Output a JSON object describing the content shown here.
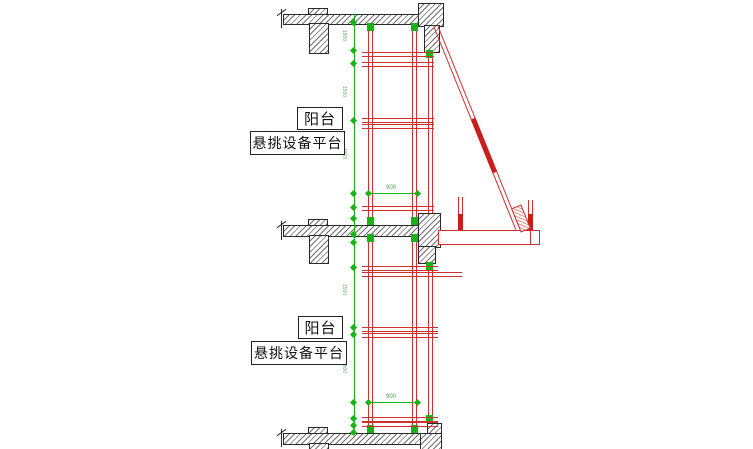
{
  "drawing": {
    "labels": {
      "balcony_upper": "阳台",
      "platform_upper": "悬挑设备平台",
      "balcony_lower": "阳台",
      "platform_lower": "悬挑设备平台"
    },
    "dims": {
      "chain": [
        "1800",
        "1500",
        "1800",
        "1500",
        "1800"
      ],
      "bay_upper": "900",
      "bay_lower": "900"
    },
    "colors": {
      "scaffold_red": "#d03030",
      "anchor_green": "#17b317",
      "concrete_outline": "#2a2a2a",
      "hatch_gray": "#6f6f6f",
      "label_text": "#111111"
    }
  }
}
